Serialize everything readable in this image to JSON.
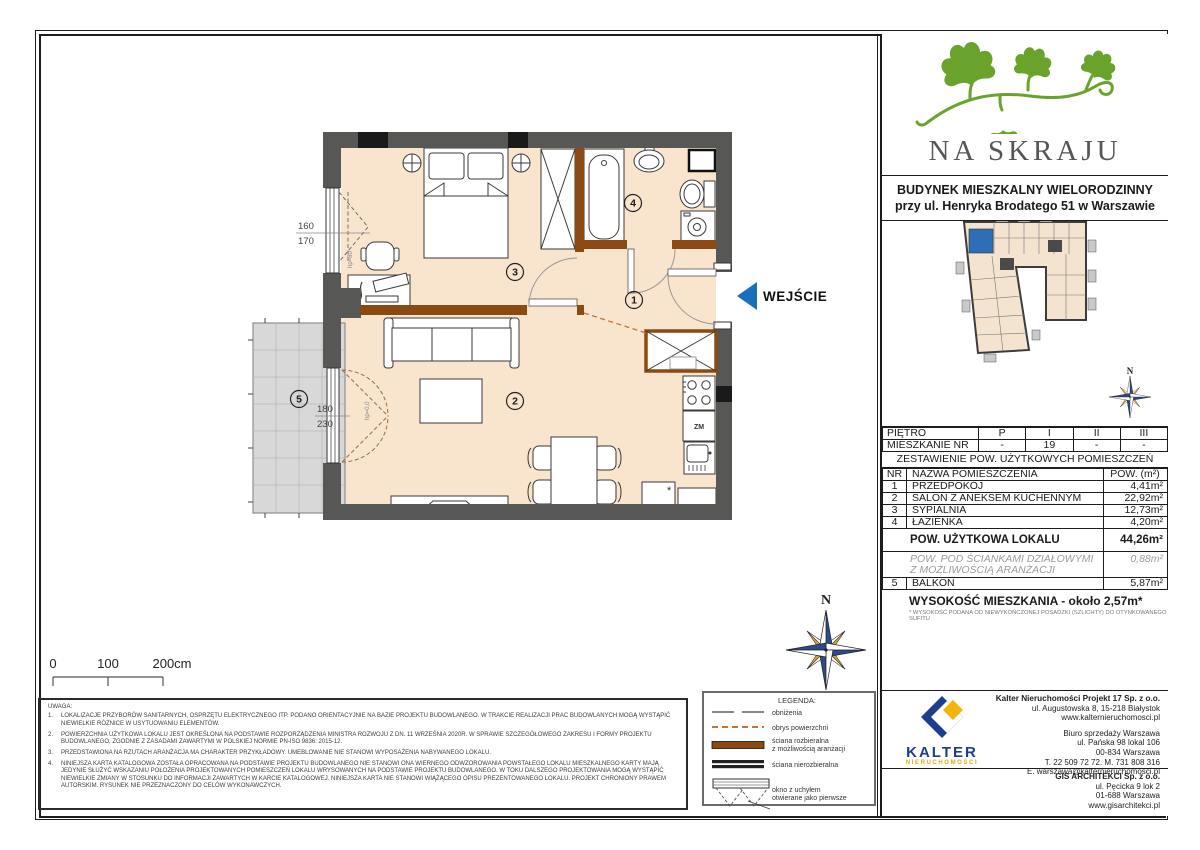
{
  "project": {
    "name": "NA SKRAJU",
    "building_line1": "BUDYNEK MIESZKALNY WIELORODZINNY",
    "building_line2": "przy ul. Henryka Brodatego 51 w Warszawie"
  },
  "floor_table": {
    "floor_label": "PIĘTRO",
    "floor_values": [
      "P",
      "I",
      "II",
      "III"
    ],
    "apt_label": "MIESZKANIE NR",
    "apt_values": [
      "-",
      "19",
      "-",
      "-"
    ]
  },
  "area_table": {
    "title": "ZESTAWIENIE POW. UŻYTKOWYCH POMIESZCZEŃ",
    "col_nr": "NR",
    "col_name": "NAZWA POMIESZCZENIA",
    "col_area": "POW. (m²)",
    "rows": [
      {
        "nr": "1",
        "name": "PRZEDPOKÓJ",
        "area": "4,41m²"
      },
      {
        "nr": "2",
        "name": "SALON Z ANEKSEM KUCHENNYM",
        "area": "22,92m²"
      },
      {
        "nr": "3",
        "name": "SYPIALNIA",
        "area": "12,73m²"
      },
      {
        "nr": "4",
        "name": "ŁAZIENKA",
        "area": "4,20m²"
      }
    ],
    "total_label": "POW. UŻYTKOWA LOKALU",
    "total_value": "44,26m²",
    "partition_line1": "POW. POD ŚCIANKAMI DZIAŁOWYMI",
    "partition_line2": "Z MOŻLIWOŚCIĄ ARANŻACJI",
    "partition_value": "0,88m²",
    "balcony_nr": "5",
    "balcony_name": "BALKON",
    "balcony_value": "5,87m²",
    "height_text": "WYSOKOŚĆ MIESZKANIA - około 2,57m*",
    "height_note": "* WYSOKOŚĆ PODANA OD NIEWYKOŃCZONEJ POSADZKI (SZLICHTY) DO OTYNKOWANEGO SUFITU"
  },
  "plan": {
    "room_hall": "1",
    "room_living": "2",
    "room_bedroom": "3",
    "room_bath": "4",
    "room_balcony": "5",
    "entrance": "WEJŚCIE",
    "window_dim_top": "160",
    "window_dim_bottom": "170",
    "balcony_dim_top": "180",
    "balcony_dim_bottom": "230",
    "window_hp": "hp=80",
    "balcony_hp": "hp=0,0",
    "dishwasher": "ZM",
    "fridge_mark": "*",
    "north": "N",
    "scale_0": "0",
    "scale_100": "100",
    "scale_200": "200cm"
  },
  "legend": {
    "title": "LEGENDA:",
    "item1": "obniżenia",
    "item2": "obrys powierzchni",
    "item3a": "ściana rozbieralna",
    "item3b": "z możliwością aranżacji",
    "item4": "ściana nierozbieralna",
    "item5a": "okno z uchyłem",
    "item5b": "otwierane jako pierwsze"
  },
  "notes": {
    "title": "UWAGA:",
    "items": [
      {
        "num": "1.",
        "text": "LOKALIZACJE PRZYBORÓW SANITARNYCH, OSPRZĘTU ELEKTRYCZNEGO ITP. PODANO ORIENTACYJNIE NA BAZIE PROJEKTU BUDOWLANEGO. W TRAKCIE REALIZACJI PRAC BUDOWLANYCH MOGĄ WYSTĄPIĆ NIEWIELKIE RÓŻNICE W USYTUOWANIU ELEMENTÓW."
      },
      {
        "num": "2.",
        "text": "POWIERZCHNIA UŻYTKOWA LOKALU JEST OKREŚLONA NA PODSTAWIE ROZPORZĄDZENIA MINISTRA ROZWOJU Z DN. 11 WRZEŚNIA 2020R. W SPRAWIE SZCZEGÓŁOWEGO ZAKRESU I FORMY PROJEKTU BUDOWLANEGO, ZGODNIE Z ZASADAMI ZAWARTYMI W POLSKIEJ NORMIE PN-ISO 9836: 2015-12."
      },
      {
        "num": "3.",
        "text": "PRZEDSTAWIONA NA RZUTACH ARANŻACJA MA CHARAKTER PRZYKŁADOWY. UMEBLOWANIE NIE STANOWI WYPOSAŻENIA NABYWANEGO LOKALU."
      },
      {
        "num": "4.",
        "text": "NINIEJSZA KARTA KATALOGOWA ZOSTAŁA OPRACOWANA NA PODSTAWIE PROJEKTU BUDOWLANEGO NIE STANOWI ONA WIERNEGO ODWZOROWANIA POWSTAŁEGO LOKALU MIESZKALNEGO KARTY MAJĄ JEDYNIE SŁUŻYĆ WSKAZANIU POŁOŻENIA PROJEKTOWANYCH POMIESZCZEŃ LOKALU WRYSOWANYCH NA PODSTAWIE PROJEKTU BUDOWLANEGO. W TOKU DALSZEGO PROJEKTOWANIA MOGĄ WYSTĄPIĆ NIEWIELKIE ZMIANY W STOSUNKU DO INFORMACJI ZAWARTYCH W KARCIE KATALOGOWEJ. NINIEJSZA KARTA NIE STANOWI WIĄŻĄCEGO OPISU PREZENTOWANEGO LOKALU. PROJEKT CHRONIONY PRAWEM AUTORSKIM. RYSUNEK NIE PRZEZNACZONY DO CELÓW WYKONAWCZYCH."
      }
    ]
  },
  "kalter": {
    "brand": "KALTER",
    "brand_sub": "nieruchomości",
    "company": "Kalter Nieruchomości Projekt 17 Sp. z o.o.",
    "addr1": "ul. Augustowska 8, 15-218 Białystok",
    "addr2": "www.kalternieruchomosci.pl",
    "office1": "Biuro sprzedaży Warszawa",
    "office2": "ul. Pańska 98 lokal 106",
    "office3": "00-834 Warszawa",
    "office4": "T. 22 509 72 72. M. 731 808 316",
    "office5": "E. warszawa@kalternieruchomosci.pl"
  },
  "gis": {
    "company": "GIS ARCHITEKCI Sp. z o.o.",
    "addr1": "ul. Pęcicka 9 lok 2",
    "addr2": "01-688 Warszawa",
    "addr3": "www.gisarchitekci.pl"
  },
  "colors": {
    "accent_blue": "#1a6fba",
    "wall_gray": "#575756",
    "wall_brown": "#8a4a12",
    "floor_fill": "#f9e4cd",
    "logo_green": "#6aa32c",
    "kalter_navy": "#1d3d91",
    "kalter_gold": "#f2b50d"
  }
}
